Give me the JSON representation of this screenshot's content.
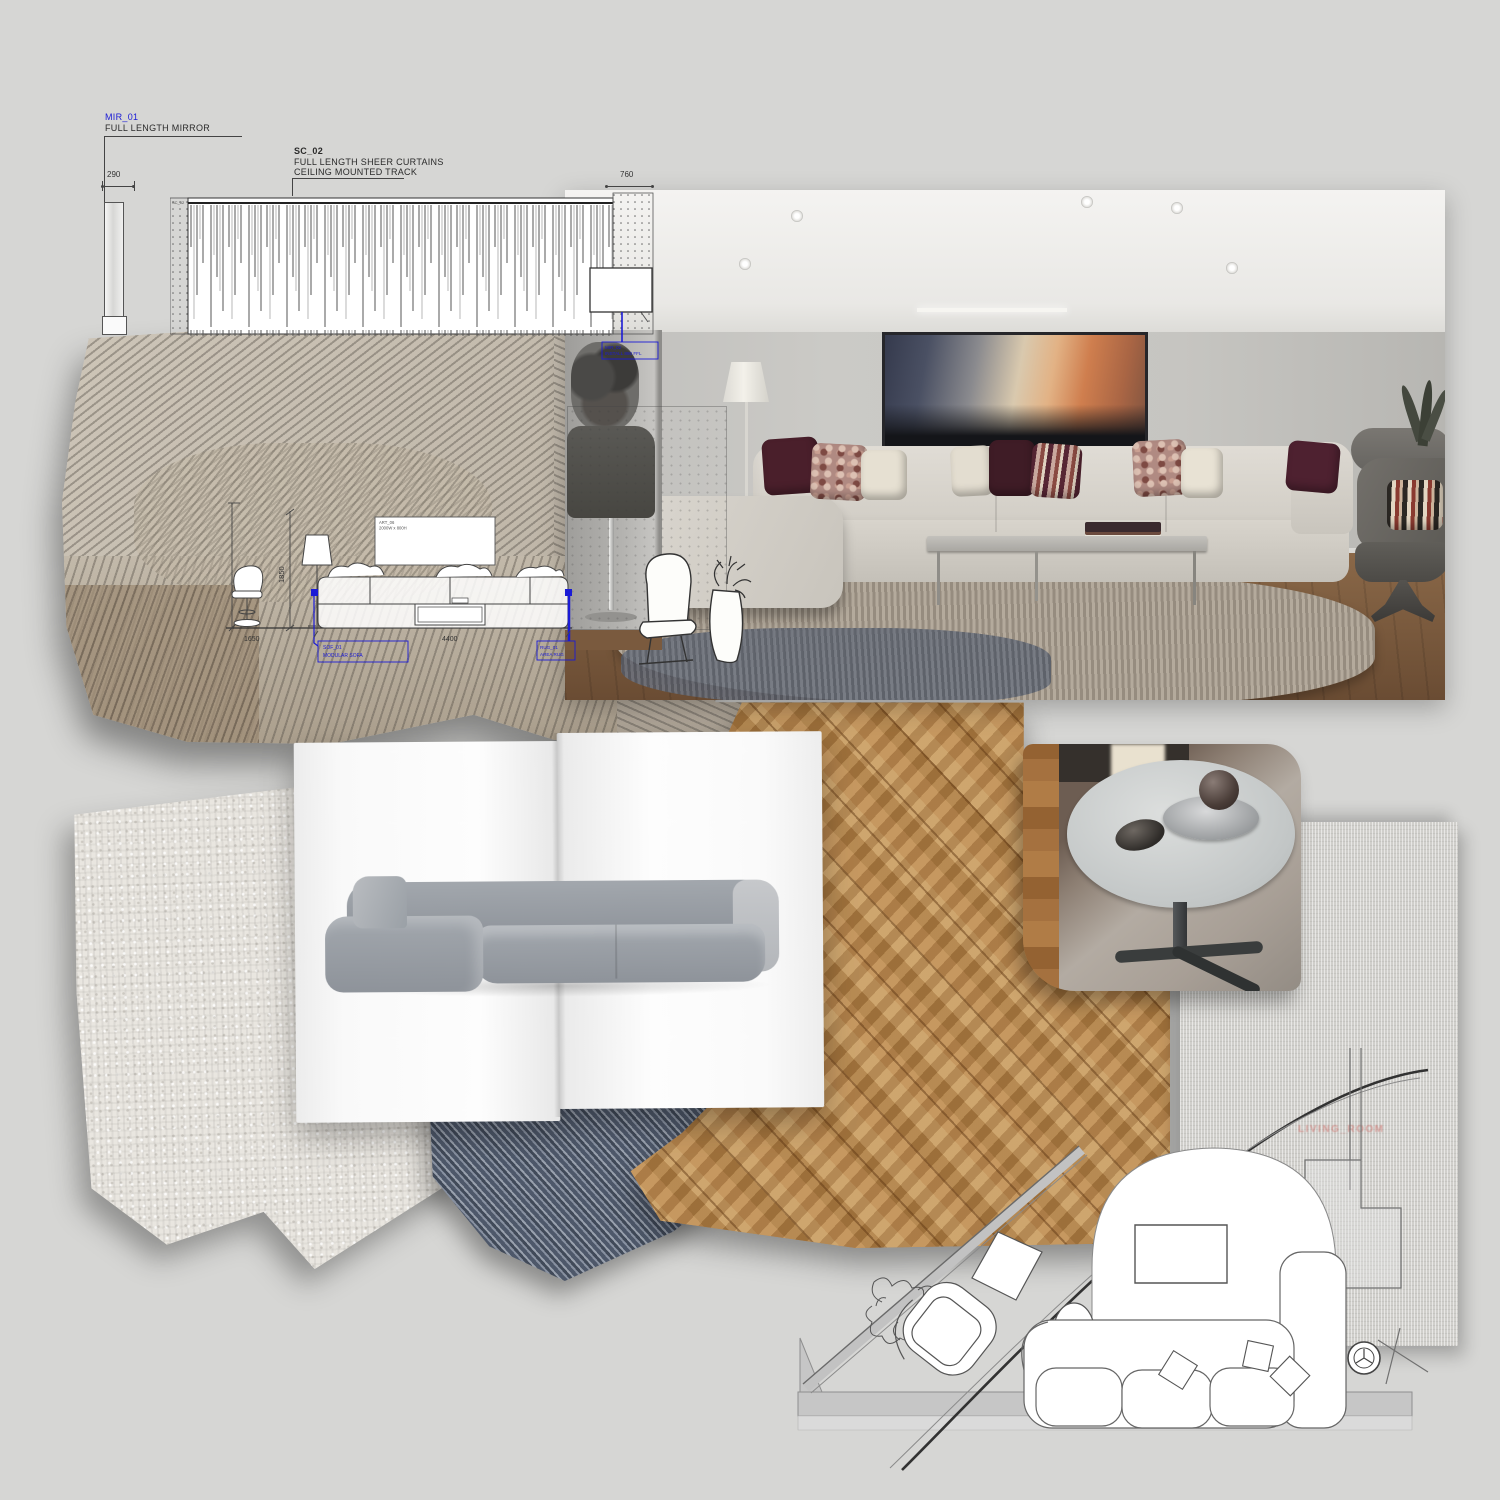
{
  "tech": {
    "mirror_code": "MIR_01",
    "mirror_label": "FULL LENGTH MIRROR",
    "mirror_dim": "290",
    "curtain_code": "SC_02",
    "curtain_line1": "FULL LENGTH SHEER CURTAINS",
    "curtain_line2": "CEILING MOUNTED TRACK",
    "curtain_dim": "760",
    "curtain_panel_tag": "SC_02"
  },
  "elevation": {
    "dim_left": "1650",
    "dim_bottom": "4400",
    "dim_height": "1850",
    "art_code": "ART_06",
    "art_size": "2000W x 800H",
    "tag_sofa_code": "SOF_01",
    "tag_sofa_label": "MODULAR SOFA",
    "tag_right_code": "RUG_01",
    "tag_right_label": "AREA RUG",
    "tag_wall_code": "MIR_02",
    "tag_wall_label": "INSTALL 880 FFL"
  },
  "plan": {
    "watermark": "LIVING_ROOM"
  },
  "colors": {
    "annotation_blue": "#1b1bd6",
    "watermark_red": "#cd5f5a",
    "background": "#d6d6d4"
  }
}
